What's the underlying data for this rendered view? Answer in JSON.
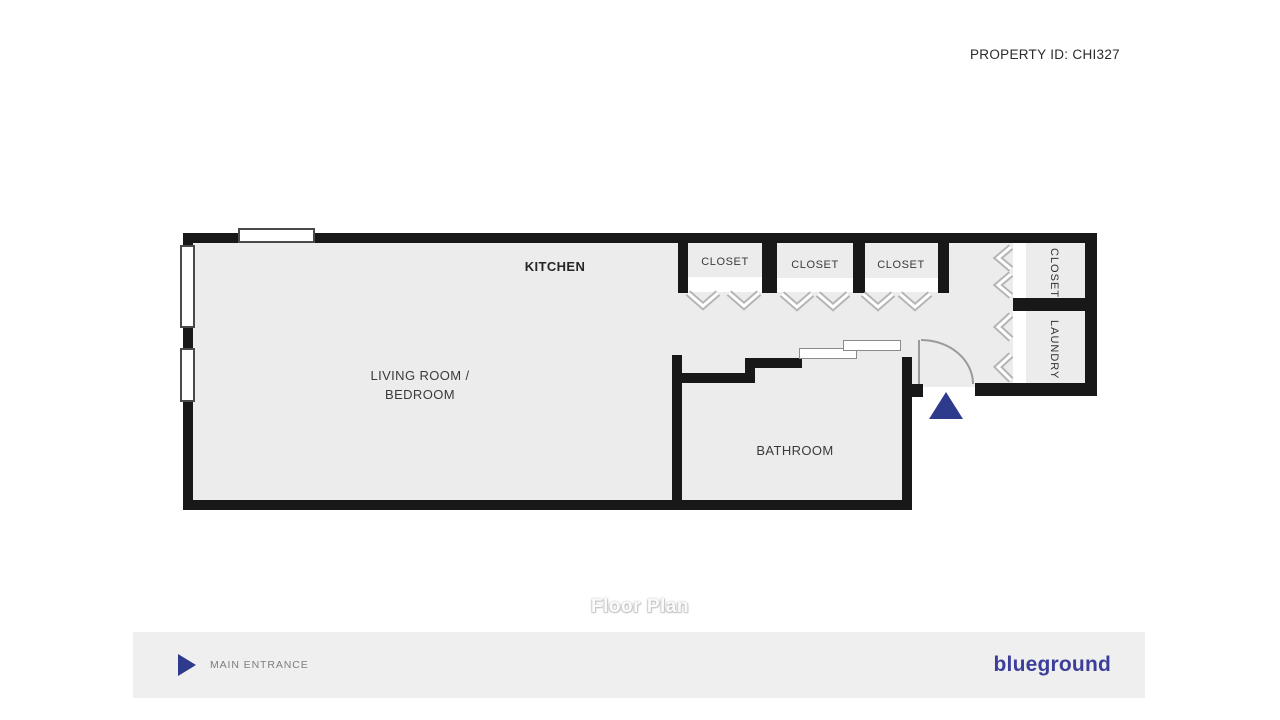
{
  "header": {
    "property_id": "PROPERTY ID: CHI327"
  },
  "plan": {
    "kitchen_label": "KITCHEN",
    "living_room_line1": "LIVING ROOM /",
    "living_room_line2": "BEDROOM",
    "bathroom_label": "BATHROOM",
    "closet_top_labels": [
      "CLOSET",
      "CLOSET",
      "CLOSET"
    ],
    "closet_side_label": "CLOSET",
    "laundry_label": "LAUNDRY",
    "caption": "Floor Plan"
  },
  "footer": {
    "legend_label": "MAIN ENTRANCE",
    "brand": "blueground"
  },
  "colors": {
    "wall": "#181818",
    "room_fill": "#ececec",
    "entrance_marker": "#2e3a8c",
    "brand_navy": "#3c3f99",
    "footer_bg": "#efefef"
  }
}
